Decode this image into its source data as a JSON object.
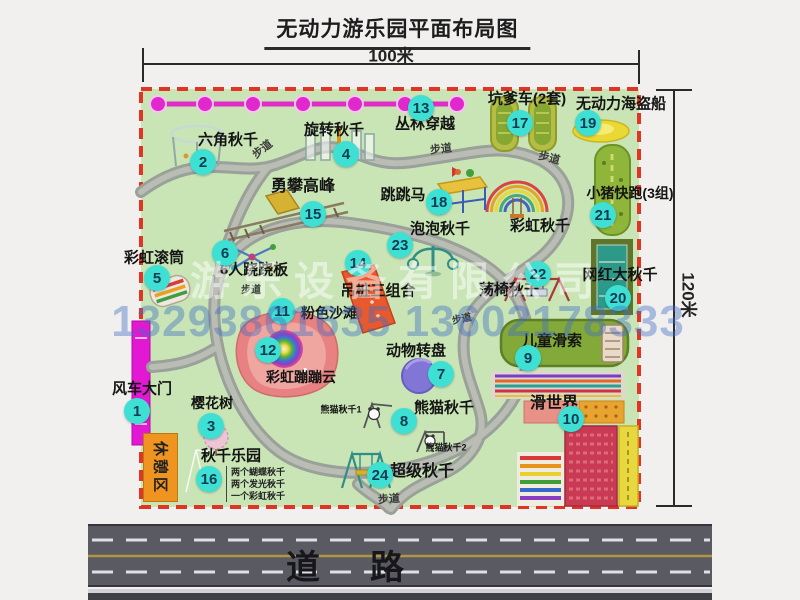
{
  "title": "无动力游乐园平面布局图",
  "dimensions": {
    "top": "100米",
    "right": "120米"
  },
  "road_label": "道　路",
  "rest_area_label": "休憩区",
  "watermark": {
    "company": "游乐设备有限公司",
    "phone": "13293861635 13602178333"
  },
  "swing_park_notes": [
    "两个蝴蝶秋千",
    "两个发光秋千",
    "一个彩虹秋千"
  ],
  "facilities": [
    {
      "num": 1,
      "name": "风车大门",
      "marker": {
        "x": 137,
        "y": 411
      },
      "label": {
        "x": 142,
        "y": 389,
        "size": 15
      }
    },
    {
      "num": 2,
      "name": "六角秋千",
      "marker": {
        "x": 203,
        "y": 162
      },
      "label": {
        "x": 228,
        "y": 140,
        "size": 15
      }
    },
    {
      "num": 3,
      "name": "樱花树",
      "marker": {
        "x": 211,
        "y": 426
      },
      "label": {
        "x": 212,
        "y": 403,
        "size": 14
      }
    },
    {
      "num": 4,
      "name": "旋转秋千",
      "marker": {
        "x": 346,
        "y": 154
      },
      "label": {
        "x": 334,
        "y": 130,
        "size": 15
      }
    },
    {
      "num": 5,
      "name": "彩虹滚筒",
      "marker": {
        "x": 157,
        "y": 278
      },
      "label": {
        "x": 154,
        "y": 258,
        "size": 15
      }
    },
    {
      "num": 6,
      "name": "6人跷跷板",
      "marker": {
        "x": 225,
        "y": 253
      },
      "label": {
        "x": 254,
        "y": 270,
        "size": 15
      }
    },
    {
      "num": 7,
      "name": "动物转盘",
      "marker": {
        "x": 441,
        "y": 374
      },
      "label": {
        "x": 416,
        "y": 351,
        "size": 15
      }
    },
    {
      "num": 8,
      "name": "熊猫秋千",
      "marker": {
        "x": 404,
        "y": 421
      },
      "label": {
        "x": 444,
        "y": 408,
        "size": 15
      }
    },
    {
      "num": 9,
      "name": "儿童滑索",
      "marker": {
        "x": 528,
        "y": 358
      },
      "label": {
        "x": 552,
        "y": 341,
        "size": 15
      }
    },
    {
      "num": 10,
      "name": "滑世界",
      "marker": {
        "x": 571,
        "y": 419
      },
      "label": {
        "x": 554,
        "y": 404,
        "size": 16
      }
    },
    {
      "num": 11,
      "name": "粉色沙滩",
      "marker": {
        "x": 282,
        "y": 311
      },
      "label": {
        "x": 329,
        "y": 313,
        "size": 14
      }
    },
    {
      "num": 12,
      "name": "彩虹蹦蹦云",
      "marker": {
        "x": 268,
        "y": 350
      },
      "label": {
        "x": 301,
        "y": 377,
        "size": 14
      }
    },
    {
      "num": 13,
      "name": "丛林穿越",
      "marker": {
        "x": 421,
        "y": 108
      },
      "label": {
        "x": 425,
        "y": 124,
        "size": 15
      }
    },
    {
      "num": 14,
      "name": "吊桩三组合",
      "marker": {
        "x": 358,
        "y": 263
      },
      "label": {
        "x": 378,
        "y": 291,
        "size": 15
      }
    },
    {
      "num": 15,
      "name": "勇攀高峰",
      "marker": {
        "x": 313,
        "y": 214
      },
      "label": {
        "x": 303,
        "y": 187,
        "size": 16
      }
    },
    {
      "num": 16,
      "name": "秋千乐园",
      "marker": {
        "x": 209,
        "y": 479
      },
      "label": {
        "x": 231,
        "y": 456,
        "size": 15
      }
    },
    {
      "num": 17,
      "name": "坑爹车(2套)",
      "marker": {
        "x": 520,
        "y": 123
      },
      "label": {
        "x": 527,
        "y": 99,
        "size": 15
      }
    },
    {
      "num": 18,
      "name": "跳跳马",
      "marker": {
        "x": 439,
        "y": 202
      },
      "label": {
        "x": 403,
        "y": 195,
        "size": 15
      }
    },
    {
      "num": 19,
      "name": "无动力海盗船",
      "marker": {
        "x": 588,
        "y": 123
      },
      "label": {
        "x": 621,
        "y": 104,
        "size": 15
      }
    },
    {
      "num": 20,
      "name": "网红大秋千",
      "marker": {
        "x": 618,
        "y": 298
      },
      "label": {
        "x": 620,
        "y": 275,
        "size": 15
      }
    },
    {
      "num": 21,
      "name": "小猪快跑(3组)",
      "marker": {
        "x": 603,
        "y": 215
      },
      "label": {
        "x": 630,
        "y": 193,
        "size": 14
      }
    },
    {
      "num": 22,
      "name": "荡椅秋千",
      "marker": {
        "x": 538,
        "y": 274
      },
      "label": {
        "x": 509,
        "y": 290,
        "size": 15
      }
    },
    {
      "num": 23,
      "name": "泡泡秋千",
      "marker": {
        "x": 400,
        "y": 245
      },
      "label": {
        "x": 440,
        "y": 229,
        "size": 15
      }
    },
    {
      "num": 24,
      "name": "超级秋千",
      "marker": {
        "x": 380,
        "y": 475
      },
      "label": {
        "x": 422,
        "y": 472,
        "size": 16
      }
    }
  ],
  "extra_labels": [
    {
      "text": "彩虹秋千",
      "x": 540,
      "y": 226,
      "size": 15
    },
    {
      "text": "熊猫秋千1",
      "x": 341,
      "y": 410,
      "size": 9
    },
    {
      "text": "熊猫秋千2",
      "x": 446,
      "y": 448,
      "size": 9
    }
  ],
  "path_labels": [
    {
      "text": "步道",
      "x": 263,
      "y": 150,
      "rot": -38,
      "size": 11
    },
    {
      "text": "步道",
      "x": 441,
      "y": 150,
      "rot": -6,
      "size": 11
    },
    {
      "text": "步道",
      "x": 549,
      "y": 159,
      "rot": 14,
      "size": 11
    },
    {
      "text": "步道",
      "x": 251,
      "y": 291,
      "rot": 0,
      "size": 10
    },
    {
      "text": "步道",
      "x": 462,
      "y": 320,
      "rot": -12,
      "size": 10
    },
    {
      "text": "步道",
      "x": 389,
      "y": 500,
      "rot": -4,
      "size": 11
    }
  ],
  "colors": {
    "marker": "#3fe0d4",
    "park_green": "#c9e5b6",
    "border_red": "#e03524",
    "path_gray": "#9aa09a",
    "road_gray": "#5a5a63",
    "chain_pink": "#df2cc6",
    "gate_magenta": "#e318d2",
    "rest_orange": "#ef9420",
    "watermark_blue": "#4a74c4"
  }
}
